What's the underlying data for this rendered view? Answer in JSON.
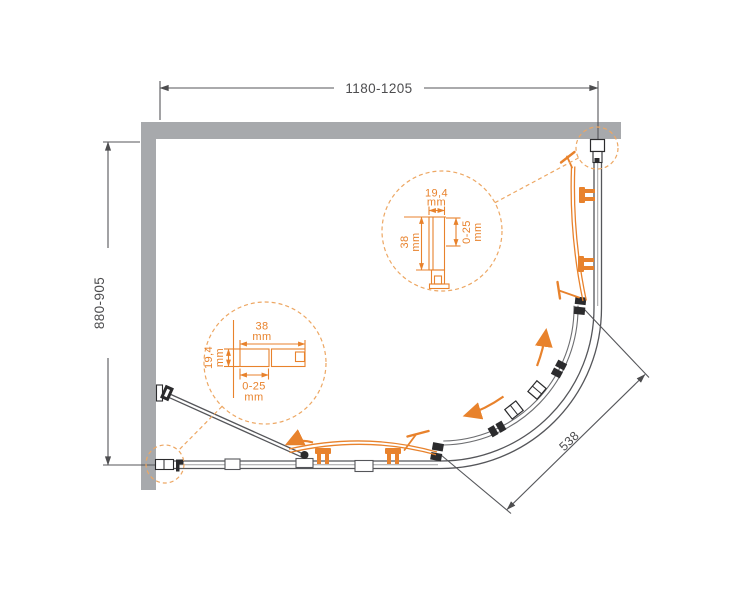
{
  "drawing": {
    "overall_width_range": "1180-1205",
    "overall_depth_range": "880-905",
    "curve_chord": "538"
  },
  "detail_top": {
    "profile_width": "19,4",
    "profile_width_unit": "mm",
    "profile_depth": "38",
    "profile_depth_unit": "mm",
    "adjustment_range": "0-25",
    "adjustment_unit": "mm"
  },
  "detail_bottom": {
    "profile_width": "38",
    "profile_width_unit": "mm",
    "profile_depth": "19,4",
    "profile_depth_unit": "mm",
    "adjustment_range": "0-25",
    "adjustment_unit": "mm"
  },
  "colors": {
    "accent_orange": "#e8822c",
    "dashed_orange": "#eda763",
    "wall_gray": "#a7a9ac",
    "frame_gray": "#55565a",
    "hardware_black": "#2b2b2d",
    "text_dark": "#4d4d4f"
  }
}
